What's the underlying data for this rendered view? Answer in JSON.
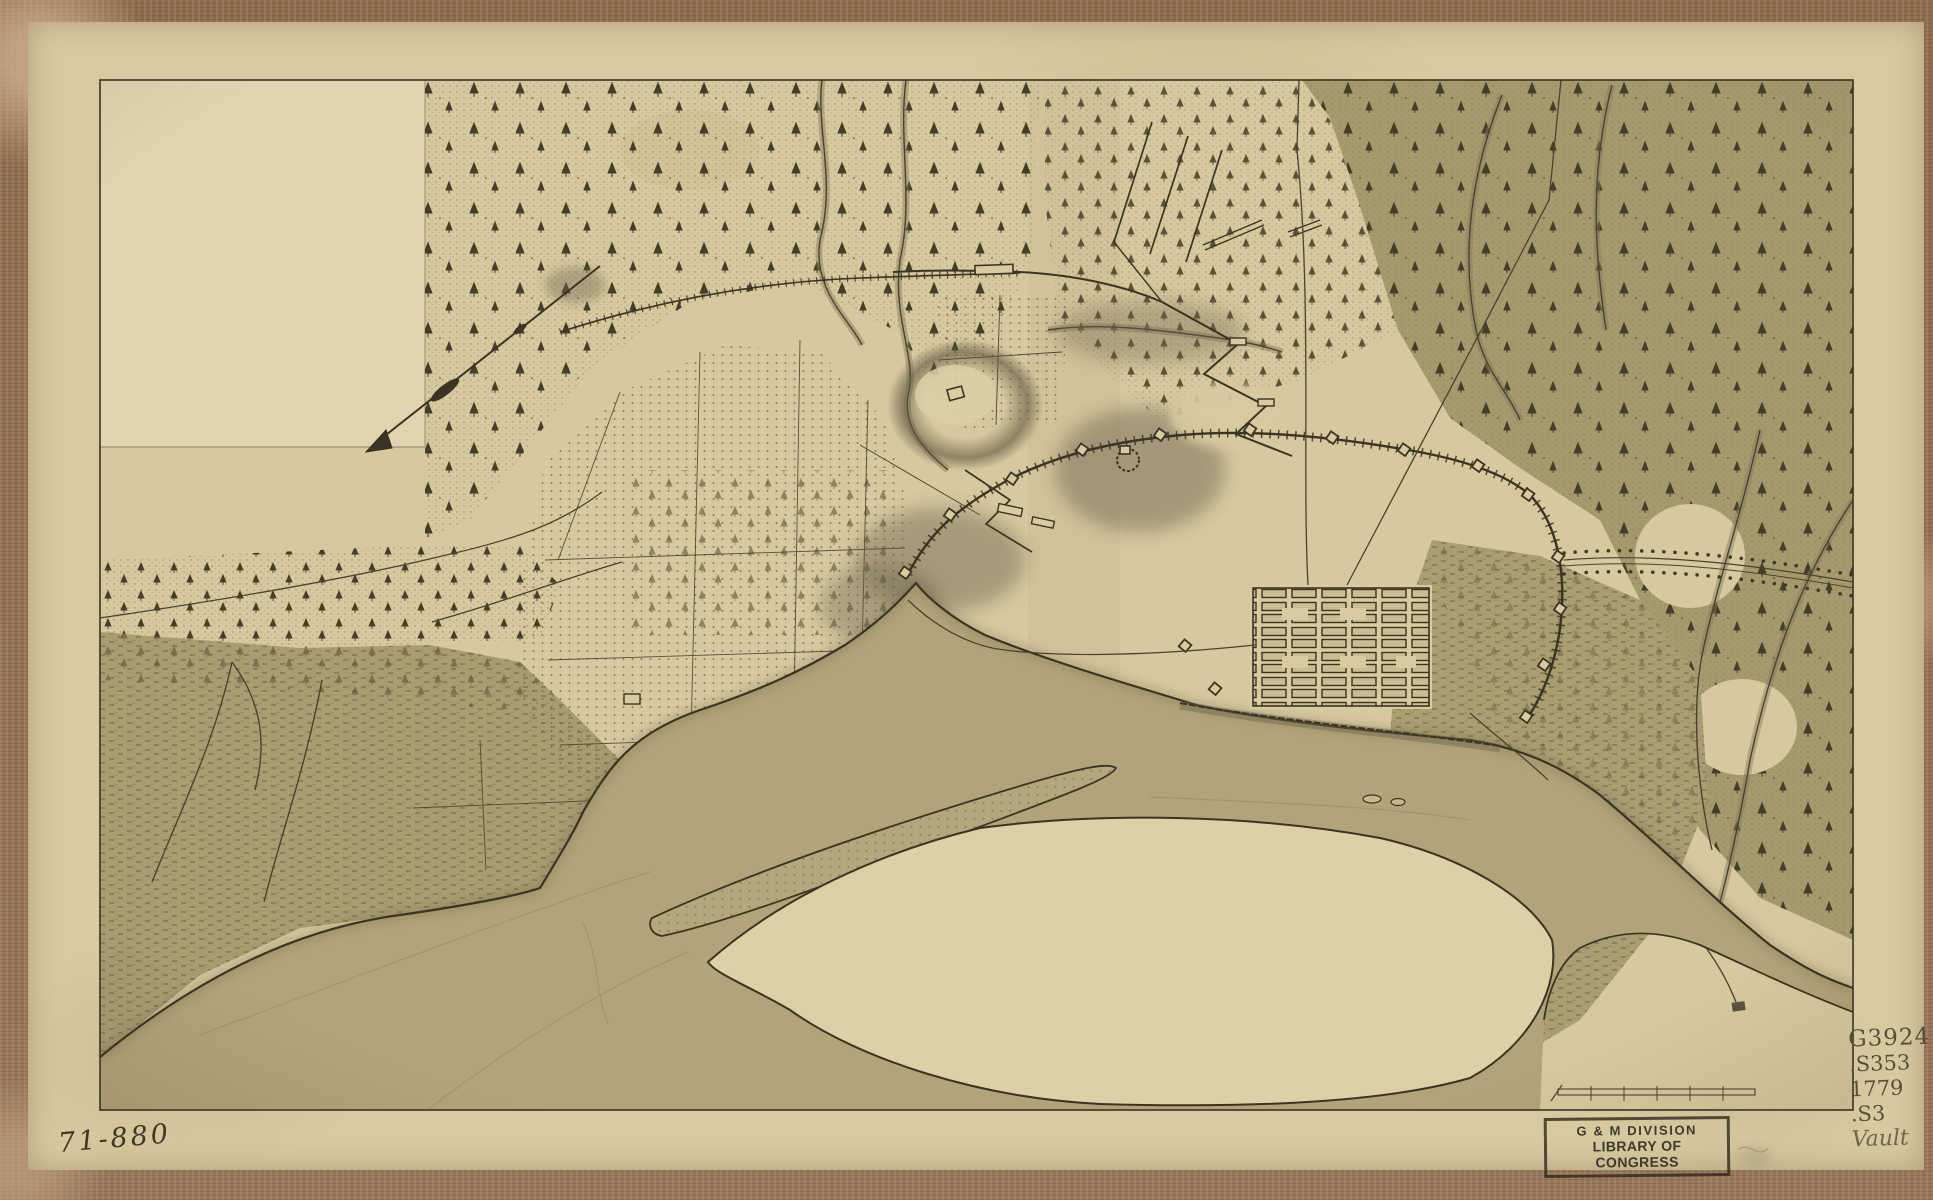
{
  "marginalia": {
    "negative_number": "71-880",
    "call_number": {
      "line1": "G3924",
      "line2": ".S353",
      "line3": "1779",
      "line4": ".S3",
      "line5": "Vault"
    },
    "stamp": {
      "line1": "G & M DIVISION",
      "line2": "LIBRARY OF CONGRESS"
    }
  },
  "map_features": [
    "blank-inset",
    "forest-northwest",
    "pine-swamp-northeast",
    "left-marsh",
    "plantation-fields",
    "river",
    "sand-island",
    "marsh-island",
    "town-grid",
    "fortification-line",
    "siege-trenches",
    "hill-redoubt",
    "roads",
    "streams",
    "tree-lined-avenue",
    "north-arrow",
    "scale-bar",
    "mill-pond"
  ],
  "colors": {
    "mount_wood": "#8d6c4e",
    "paper": "#d7ca9e",
    "paper_light": "#e0d5ae",
    "ink": "#3b3425",
    "river": "#b1a478",
    "marsh_olive": "#a79d6f",
    "swamp_olive": "#a49b6d",
    "island_pale": "#dbd0a6",
    "pencil": "#55503e",
    "stamp_ink": "#32302a"
  }
}
